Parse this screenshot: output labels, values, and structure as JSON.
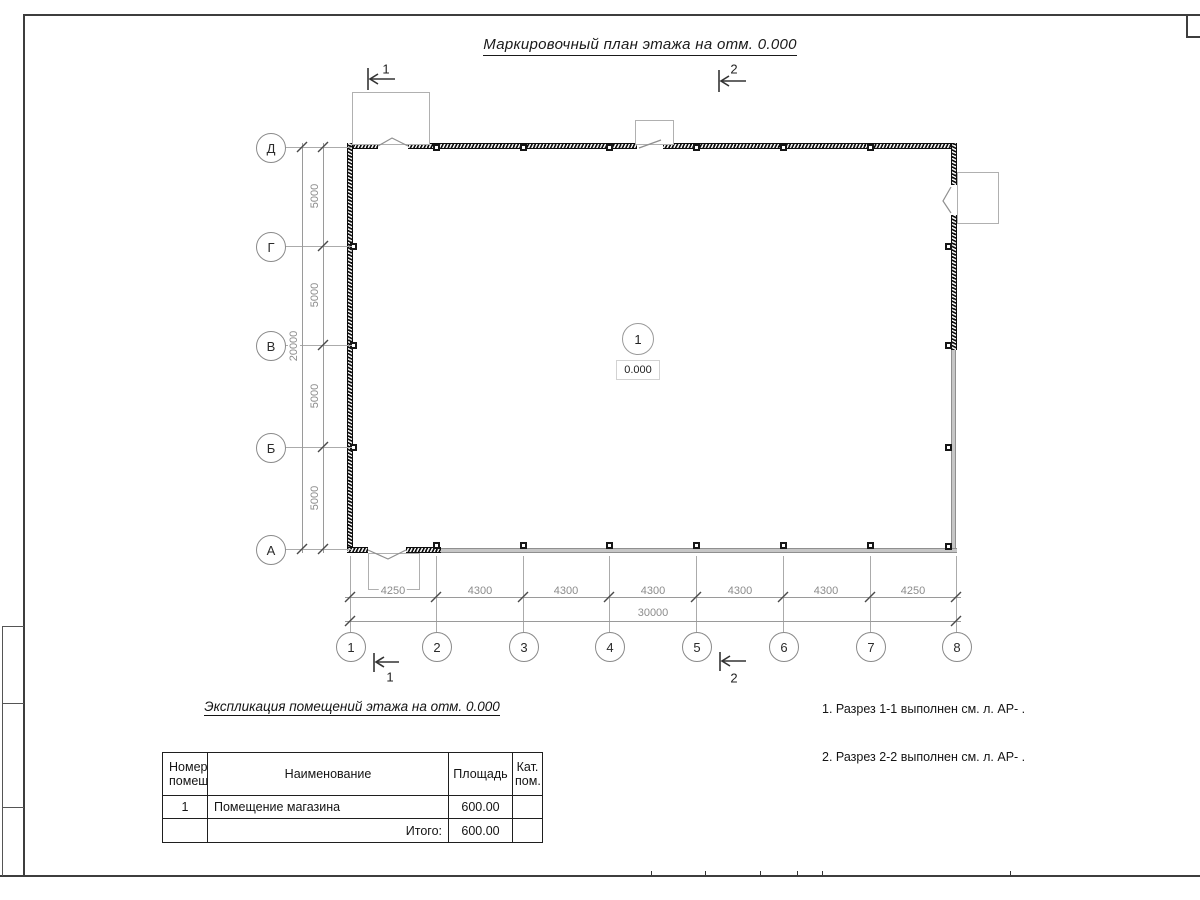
{
  "sheet": {
    "title": "Маркировочный план этажа на отм. 0.000"
  },
  "colors": {
    "wall_hatch": "#0d0d0d",
    "wall_grey": "#c6c6c6",
    "dim_text": "#8c8c8c",
    "thin_line": "#ababab",
    "text": "#1a1a1a"
  },
  "plan": {
    "row_axes": [
      "Д",
      "Г",
      "В",
      "Б",
      "А"
    ],
    "col_axes": [
      "1",
      "2",
      "3",
      "4",
      "5",
      "6",
      "7",
      "8"
    ],
    "dims_vertical": {
      "segments": [
        "5000",
        "5000",
        "5000",
        "5000"
      ],
      "total": "20000"
    },
    "dims_horizontal": {
      "segments": [
        "4250",
        "4300",
        "4300",
        "4300",
        "4300",
        "4300",
        "4250"
      ],
      "total": "30000"
    },
    "room_marker": {
      "number": "1",
      "elevation": "0.000"
    },
    "section_marks": {
      "top1": "1",
      "top2": "2",
      "bottom1": "1",
      "bottom2": "2"
    }
  },
  "notes": {
    "lines": [
      "1. Разрез 1-1 выполнен см. л. АР- .",
      "2. Разрез 2-2 выполнен см. л. АР- ."
    ]
  },
  "legend": {
    "title": "Экспликация помещений этажа на отм. 0.000",
    "headers": {
      "number_line1": "Номер",
      "number_line2": "помещ.",
      "name": "Наименование",
      "area": "Площадь",
      "cat_line1": "Кат.",
      "cat_line2": "пом."
    },
    "rows": [
      {
        "number": "1",
        "name": "Помещение магазина",
        "area": "600.00",
        "cat": ""
      }
    ],
    "total": {
      "label": "Итого:",
      "area": "600.00",
      "cat": ""
    }
  }
}
